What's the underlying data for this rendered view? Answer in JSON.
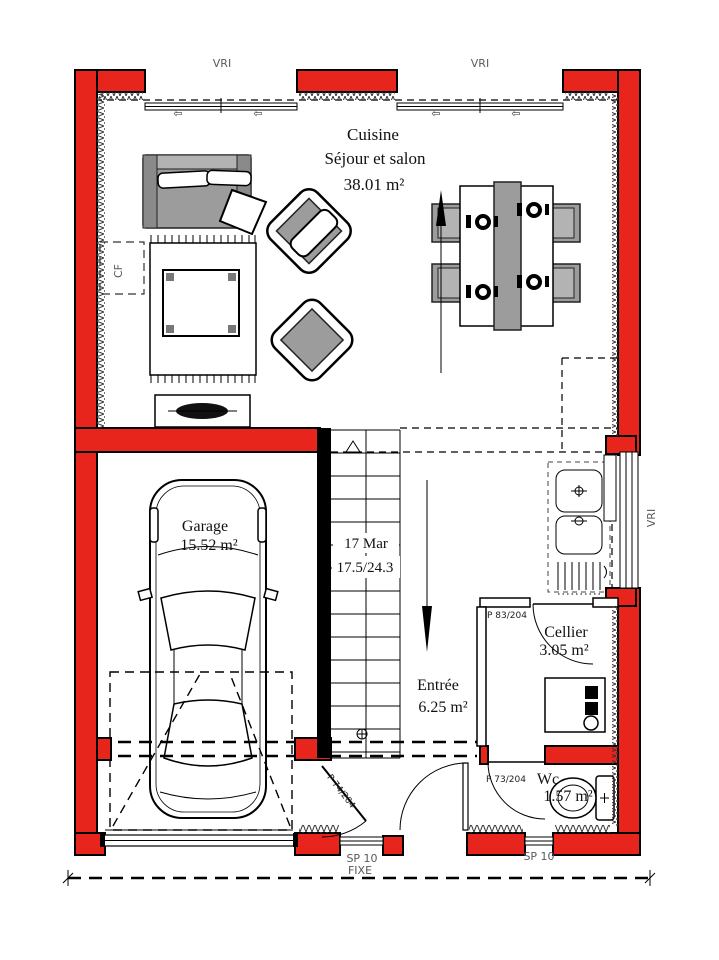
{
  "colors": {
    "wall_red": "#e8251c",
    "outline_black": "#000000",
    "furniture_gray": "#9c9c9c",
    "label_gray": "#5a5a5a"
  },
  "main_room": {
    "name_line1": "Cuisine",
    "name_line2": "Séjour et salon",
    "area": "38.01 m²"
  },
  "rooms": {
    "garage": {
      "name": "Garage",
      "area": "15.52 m²"
    },
    "entree": {
      "name": "Entrée",
      "area": "6.25 m²"
    },
    "cellier": {
      "name": "Cellier",
      "area": "3.05 m²"
    },
    "wc": {
      "name": "Wc",
      "area": "1.57 m²"
    }
  },
  "stairs": {
    "steps_note": "17 Mar",
    "dims_note": "17.5/24.3"
  },
  "windows": {
    "vri_top_left": "VRI",
    "vri_top_right": "VRI",
    "vri_right": "VRI",
    "sp10_left": "SP 10",
    "fixe_left": "FIXE",
    "sp10_right": "SP 10"
  },
  "doors": {
    "cellier_door": "P 83/204",
    "wc_door": "P 73/204",
    "garage_door": "P 74/204"
  },
  "misc": {
    "cf_label": "CF",
    "window_arrow": "⇦"
  }
}
